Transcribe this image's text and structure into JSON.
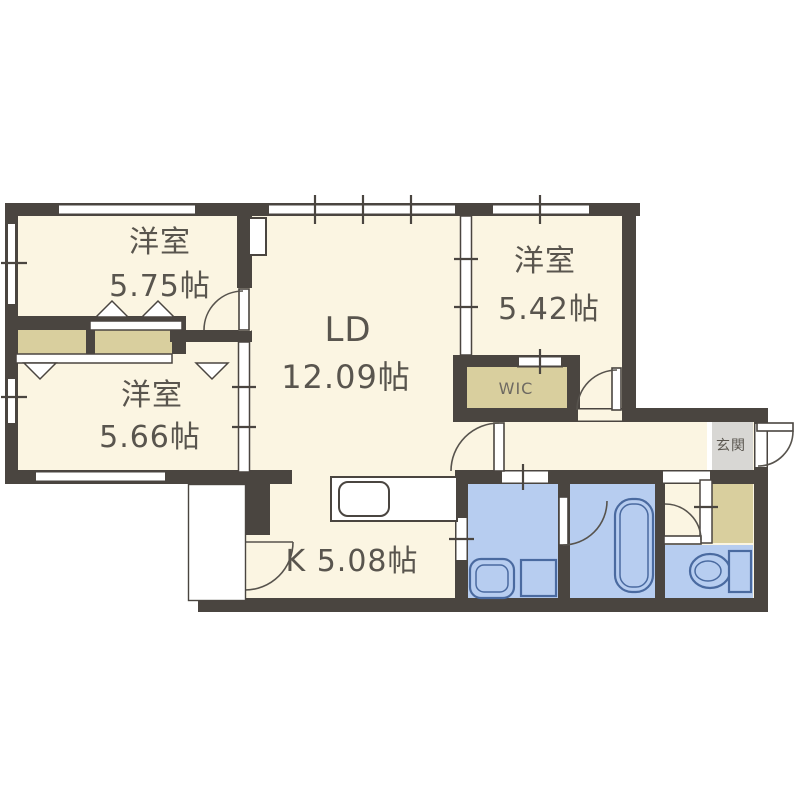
{
  "floor_plan": {
    "labels": {
      "bedroom_top_left_name": "洋室",
      "bedroom_top_left_size": "5.75帖",
      "bedroom_mid_left_name": "洋室",
      "bedroom_mid_left_size": "5.66帖",
      "bedroom_right_name": "洋室",
      "bedroom_right_size": "5.42帖",
      "living_dining_name": "LD",
      "living_dining_size": "12.09帖",
      "kitchen_label": "K 5.08帖",
      "walk_in_closet_label": "WIC",
      "entrance_label": "玄関"
    },
    "colors": {
      "wall": "#4a4540",
      "floor": "#fbf5e2",
      "closet": "#d9cf9e",
      "wet_area": "#b7cdf0",
      "fixture_line": "#4a6aa0",
      "entrance": "#d8d7d4",
      "text": "#59554e"
    }
  }
}
